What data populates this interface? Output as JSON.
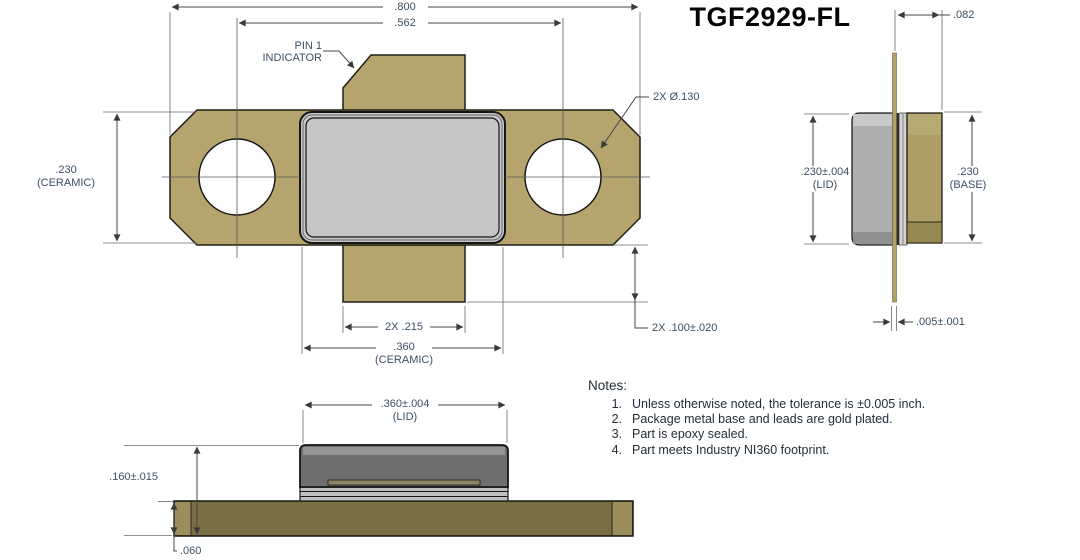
{
  "title": "TGF2929-FL",
  "colors": {
    "flange_gold": "#b5a46d",
    "lid_gray": "#c6c6c6",
    "side_lid_gray": "#aeaeae",
    "side_base_gold": "#ac9e64",
    "base_olive": "#7a6e45",
    "base_cap_gold": "#9c8e5c",
    "bottom_lid_gray": "#6f6f6f",
    "lead_gold": "#b2a266",
    "dim_text": "#3b4f63",
    "notes_text": "#232e3b"
  },
  "front_view": {
    "labels": {
      "pin1_line1": "PIN 1",
      "pin1_line2": "INDICATOR"
    },
    "dims": {
      "overall_width": ".800",
      "hole_spacing": ".562",
      "ceramic_height": ".230",
      "ceramic_height_note": "(CERAMIC)",
      "hole_diameter": "2X Ø.130",
      "lead_width": "2X .215",
      "ceramic_width": ".360",
      "ceramic_width_note": "(CERAMIC)",
      "lead_extension": "2X .100±.020"
    }
  },
  "side_view": {
    "dims": {
      "lead_setback": ".082",
      "lid_height": ".230±.004",
      "lid_height_note": "(LID)",
      "base_height": ".230",
      "base_height_note": "(BASE)",
      "lead_thickness": ".005±.001"
    }
  },
  "bottom_view": {
    "dims": {
      "lid_width": ".360±.004",
      "lid_width_note": "(LID)",
      "overall_height": ".160±.015",
      "base_thickness": ".060"
    }
  },
  "notes": {
    "heading": "Notes:",
    "items": [
      {
        "num": "1.",
        "text": "Unless otherwise noted, the tolerance is ±0.005 inch."
      },
      {
        "num": "2.",
        "text": "Package metal base and leads are gold plated."
      },
      {
        "num": "3.",
        "text": "Part is epoxy sealed."
      },
      {
        "num": "4.",
        "text": "Part meets Industry NI360 footprint."
      }
    ]
  }
}
